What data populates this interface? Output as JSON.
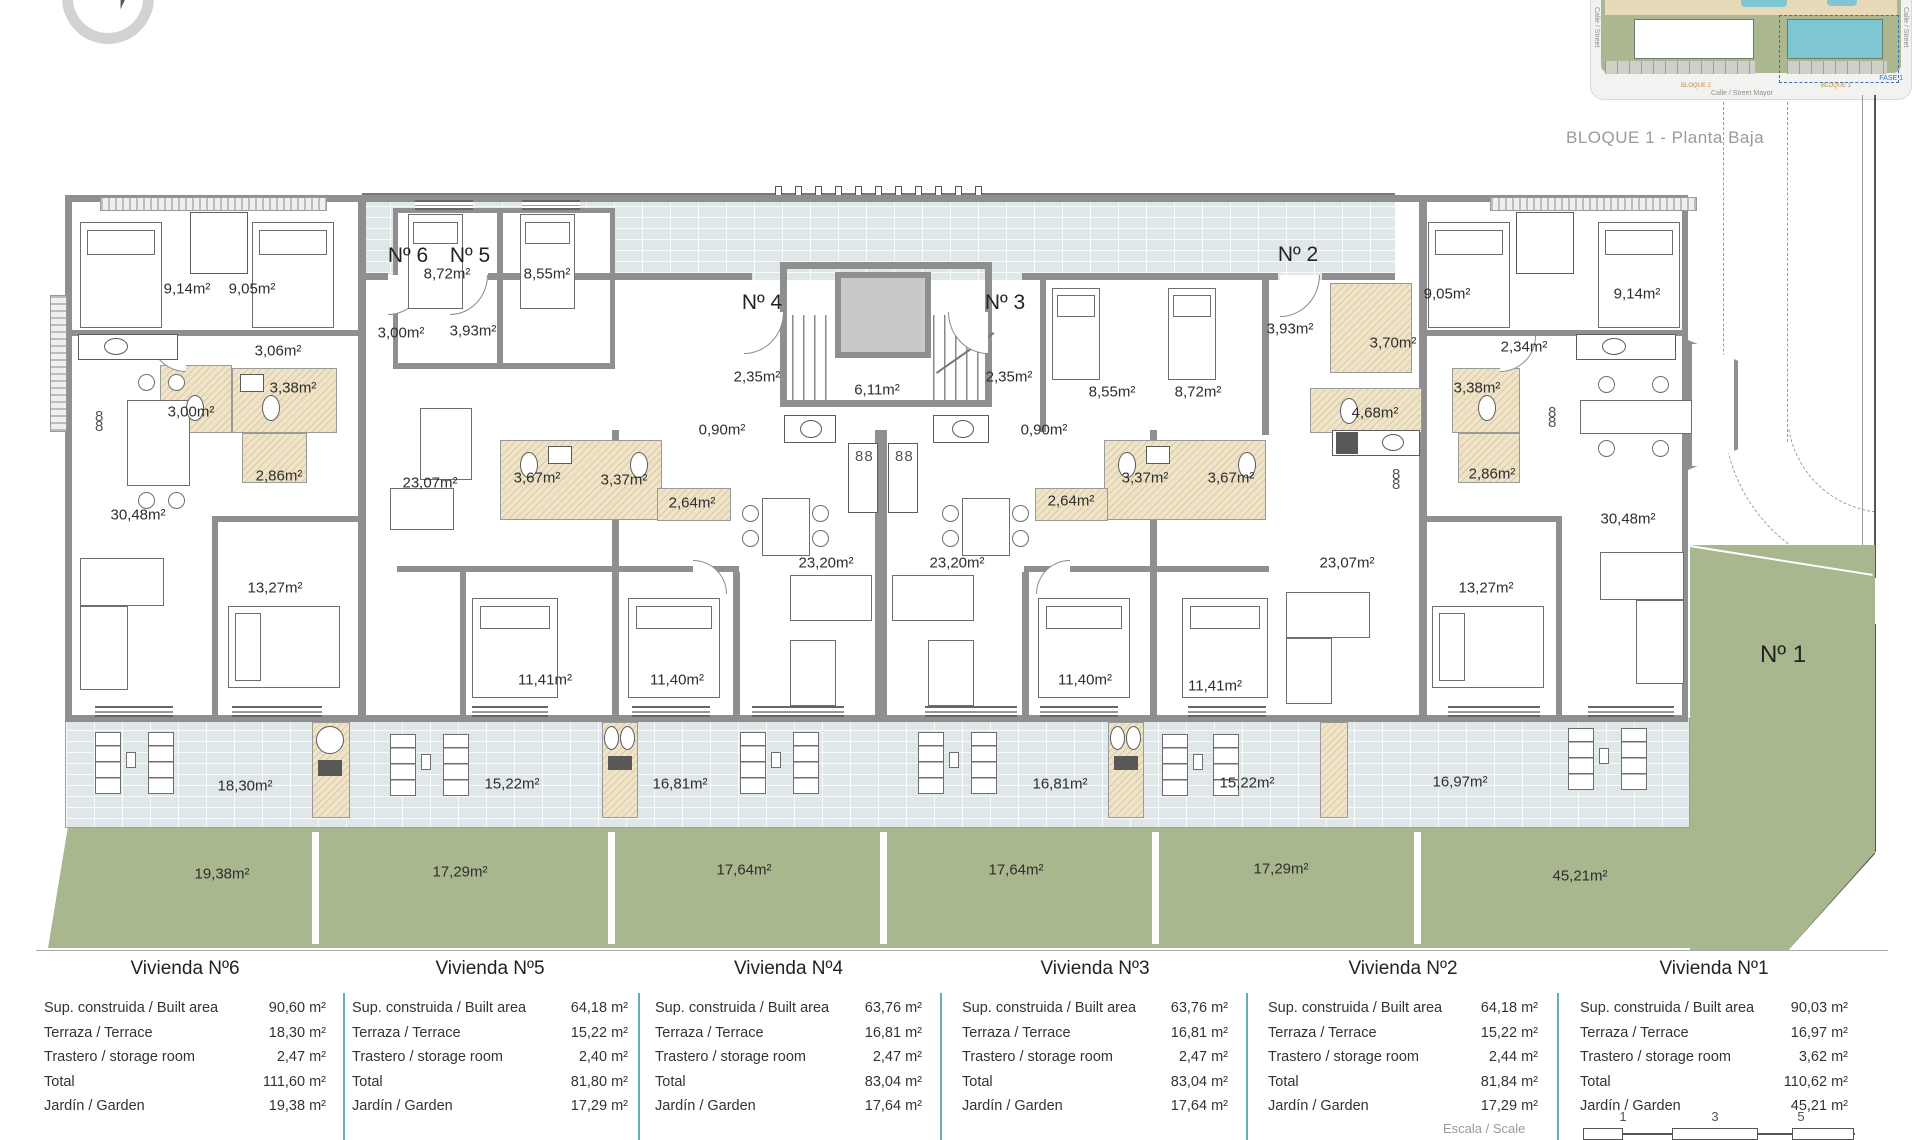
{
  "title": "BLOQUE 1 - Planta Baja",
  "inset": {
    "street_bottom": "Calle / Street  Mayor",
    "street_right": "Calle / Street",
    "street_left": "Calle / Street",
    "fase_label": "FASE 1",
    "bloque_left_label": "BLOQUE 2",
    "bloque_right_label": "BLOQUE 1",
    "highlight_color": "#7ec6d1"
  },
  "compass": {
    "name": "north-compass"
  },
  "scalebar": {
    "label": "Escala / Scale",
    "ticks": [
      "1",
      "3",
      "5"
    ]
  },
  "plan": {
    "unit_markers": [
      {
        "text": "Nº 6",
        "x": 408,
        "y": 256
      },
      {
        "text": "Nº 5",
        "x": 470,
        "y": 256
      },
      {
        "text": "Nº 4",
        "x": 762,
        "y": 303
      },
      {
        "text": "Nº 3",
        "x": 1005,
        "y": 303
      },
      {
        "text": "Nº 2",
        "x": 1298,
        "y": 255
      },
      {
        "text": "Nº 1",
        "x": 1783,
        "y": 655,
        "big": true
      }
    ],
    "room_labels": [
      {
        "text": "9,14m²",
        "x": 187,
        "y": 289
      },
      {
        "text": "9,05m²",
        "x": 252,
        "y": 289
      },
      {
        "text": "3,06m²",
        "x": 278,
        "y": 351
      },
      {
        "text": "3,38m²",
        "x": 293,
        "y": 388
      },
      {
        "text": "3,00m²",
        "x": 191,
        "y": 412
      },
      {
        "text": "2,86m²",
        "x": 279,
        "y": 476
      },
      {
        "text": "30,48m²",
        "x": 138,
        "y": 515
      },
      {
        "text": "13,27m²",
        "x": 275,
        "y": 588
      },
      {
        "text": "3,00m²",
        "x": 401,
        "y": 333
      },
      {
        "text": "3,93m²",
        "x": 473,
        "y": 331
      },
      {
        "text": "8,72m²",
        "x": 447,
        "y": 274
      },
      {
        "text": "8,55m²",
        "x": 547,
        "y": 274
      },
      {
        "text": "23,07m²",
        "x": 430,
        "y": 483
      },
      {
        "text": "3,67m²",
        "x": 537,
        "y": 478
      },
      {
        "text": "3,37m²",
        "x": 624,
        "y": 480
      },
      {
        "text": "11,41m²",
        "x": 545,
        "y": 680
      },
      {
        "text": "2,35m²",
        "x": 757,
        "y": 377
      },
      {
        "text": "0,90m²",
        "x": 722,
        "y": 430
      },
      {
        "text": "2,64m²",
        "x": 692,
        "y": 503
      },
      {
        "text": "6,11m²",
        "x": 877,
        "y": 390
      },
      {
        "text": "23,20m²",
        "x": 826,
        "y": 563
      },
      {
        "text": "11,40m²",
        "x": 677,
        "y": 680
      },
      {
        "text": "2,35m²",
        "x": 1009,
        "y": 377
      },
      {
        "text": "0,90m²",
        "x": 1044,
        "y": 430
      },
      {
        "text": "2,64m²",
        "x": 1071,
        "y": 501
      },
      {
        "text": "3,37m²",
        "x": 1145,
        "y": 478
      },
      {
        "text": "3,67m²",
        "x": 1231,
        "y": 478
      },
      {
        "text": "23,20m²",
        "x": 957,
        "y": 563
      },
      {
        "text": "11,40m²",
        "x": 1085,
        "y": 680
      },
      {
        "text": "8,55m²",
        "x": 1112,
        "y": 392
      },
      {
        "text": "8,72m²",
        "x": 1198,
        "y": 392
      },
      {
        "text": "3,93m²",
        "x": 1290,
        "y": 329
      },
      {
        "text": "3,70m²",
        "x": 1393,
        "y": 343
      },
      {
        "text": "4,68m²",
        "x": 1375,
        "y": 413
      },
      {
        "text": "23,07m²",
        "x": 1347,
        "y": 563
      },
      {
        "text": "11,41m²",
        "x": 1215,
        "y": 686
      },
      {
        "text": "9,05m²",
        "x": 1447,
        "y": 294
      },
      {
        "text": "9,14m²",
        "x": 1637,
        "y": 294
      },
      {
        "text": "2,34m²",
        "x": 1524,
        "y": 347
      },
      {
        "text": "3,38m²",
        "x": 1477,
        "y": 388
      },
      {
        "text": "2,86m²",
        "x": 1492,
        "y": 474
      },
      {
        "text": "30,48m²",
        "x": 1628,
        "y": 519
      },
      {
        "text": "13,27m²",
        "x": 1486,
        "y": 588
      },
      {
        "text": "18,30m²",
        "x": 245,
        "y": 786
      },
      {
        "text": "15,22m²",
        "x": 512,
        "y": 784
      },
      {
        "text": "16,81m²",
        "x": 680,
        "y": 784
      },
      {
        "text": "16,81m²",
        "x": 1060,
        "y": 784
      },
      {
        "text": "15,22m²",
        "x": 1247,
        "y": 783
      },
      {
        "text": "16,97m²",
        "x": 1460,
        "y": 782
      },
      {
        "text": "19,38m²",
        "x": 222,
        "y": 874
      },
      {
        "text": "17,29m²",
        "x": 460,
        "y": 872
      },
      {
        "text": "17,64m²",
        "x": 744,
        "y": 870
      },
      {
        "text": "17,64m²",
        "x": 1016,
        "y": 870
      },
      {
        "text": "17,29m²",
        "x": 1281,
        "y": 869
      },
      {
        "text": "45,21m²",
        "x": 1580,
        "y": 876
      }
    ]
  },
  "table": {
    "row_names": [
      "Sup. construida / Built area",
      "Terraza / Terrace",
      "Trastero / storage room",
      "Total",
      "Jardín / Garden"
    ],
    "columns": [
      {
        "header": "Vivienda Nº6",
        "values": [
          "90,60 m²",
          "18,30 m²",
          "2,47 m²",
          "111,60 m²",
          "19,38 m²"
        ]
      },
      {
        "header": "Vivienda Nº5",
        "values": [
          "64,18 m²",
          "15,22 m²",
          "2,40 m²",
          "81,80 m²",
          "17,29 m²"
        ]
      },
      {
        "header": "Vivienda Nº4",
        "values": [
          "63,76 m²",
          "16,81 m²",
          "2,47 m²",
          "83,04 m²",
          "17,64 m²"
        ]
      },
      {
        "header": "Vivienda Nº3",
        "values": [
          "63,76 m²",
          "16,81 m²",
          "2,47 m²",
          "83,04 m²",
          "17,64 m²"
        ]
      },
      {
        "header": "Vivienda Nº2",
        "values": [
          "64,18 m²",
          "15,22 m²",
          "2,44 m²",
          "81,84 m²",
          "17,29 m²"
        ]
      },
      {
        "header": "Vivienda Nº1",
        "values": [
          "90,03 m²",
          "16,97 m²",
          "3,62 m²",
          "110,62 m²",
          "45,21 m²"
        ]
      }
    ]
  }
}
